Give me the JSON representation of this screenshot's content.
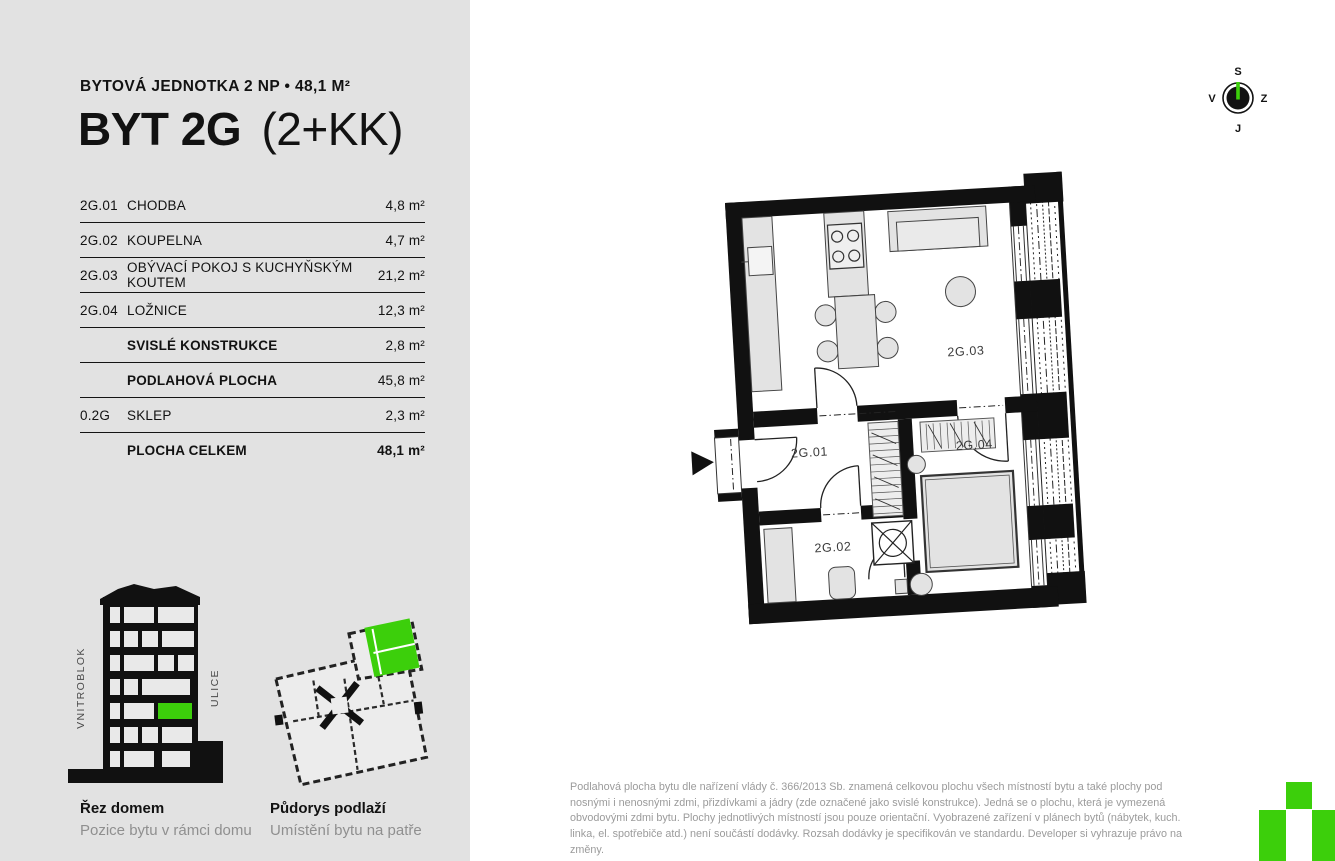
{
  "page": {
    "background": "#ffffff",
    "panel_background": "#e2e2e2",
    "accent_green": "#3ccf0b",
    "ink": "#121212",
    "muted_text": "#9b9b9b"
  },
  "header": {
    "kicker": "BYTOVÁ JEDNOTKA 2 NP • 48,1 M²",
    "title": "BYT 2G",
    "title_suffix": "(2+KK)"
  },
  "area_table": {
    "rows": [
      {
        "code": "2G.01",
        "name": "CHODBA",
        "value": "4,8 m²",
        "b": 0,
        "bv": 0
      },
      {
        "code": "2G.02",
        "name": "KOUPELNA",
        "value": "4,7 m²",
        "b": 0,
        "bv": 0
      },
      {
        "code": "2G.03",
        "name": "OBÝVACÍ POKOJ S KUCHYŇSKÝM KOUTEM",
        "value": "21,2 m²",
        "b": 0,
        "bv": 0
      },
      {
        "code": "2G.04",
        "name": "LOŽNICE",
        "value": "12,3 m²",
        "b": 0,
        "bv": 0
      },
      {
        "code": "",
        "name": "SVISLÉ KONSTRUKCE",
        "value": "2,8 m²",
        "b": 1,
        "bv": 0
      },
      {
        "code": "",
        "name": "PODLAHOVÁ PLOCHA",
        "value": "45,8 m²",
        "b": 1,
        "bv": 0
      },
      {
        "code": "0.2G",
        "name": "SKLEP",
        "value": "2,3 m²",
        "b": 0,
        "bv": 0
      },
      {
        "code": "",
        "name": "PLOCHA CELKEM",
        "value": "48,1 m²",
        "b": 1,
        "bv": 1
      }
    ]
  },
  "compass": {
    "top": "S",
    "left": "V",
    "right": "Z",
    "bottom": "J"
  },
  "floor_plan": {
    "labels": {
      "hall": "2G.01",
      "bath": "2G.02",
      "living": "2G.03",
      "bedroom": "2G.04"
    }
  },
  "section_figure": {
    "title": "Řez domem",
    "subtitle": "Pozice bytu v rámci domu",
    "left_label": "VNITROBLOK",
    "right_label": "ULICE"
  },
  "floor_figure": {
    "title": "Půdorys podlaží",
    "subtitle": "Umístění bytu na patře"
  },
  "disclaimer": "Podlahová plocha bytu dle nařízení vlády č. 366/2013 Sb. znamená celkovou plochu všech místností bytu a také plochy pod nosnými i nenosnými zdmi, přizdívkami a jádry (zde označené jako svislé konstrukce). Jedná se o plochu, která je vymezená obvodovými zdmi bytu. Plochy jednotlivých místností jsou pouze orientační. Vyobrazené zařízení v plánech bytů (nábytek, kuch. linka, el. spotřebiče atd.) není součástí dodávky. Rozsah dodávky je specifikován ve standardu. Developer si vyhrazuje právo na změny."
}
